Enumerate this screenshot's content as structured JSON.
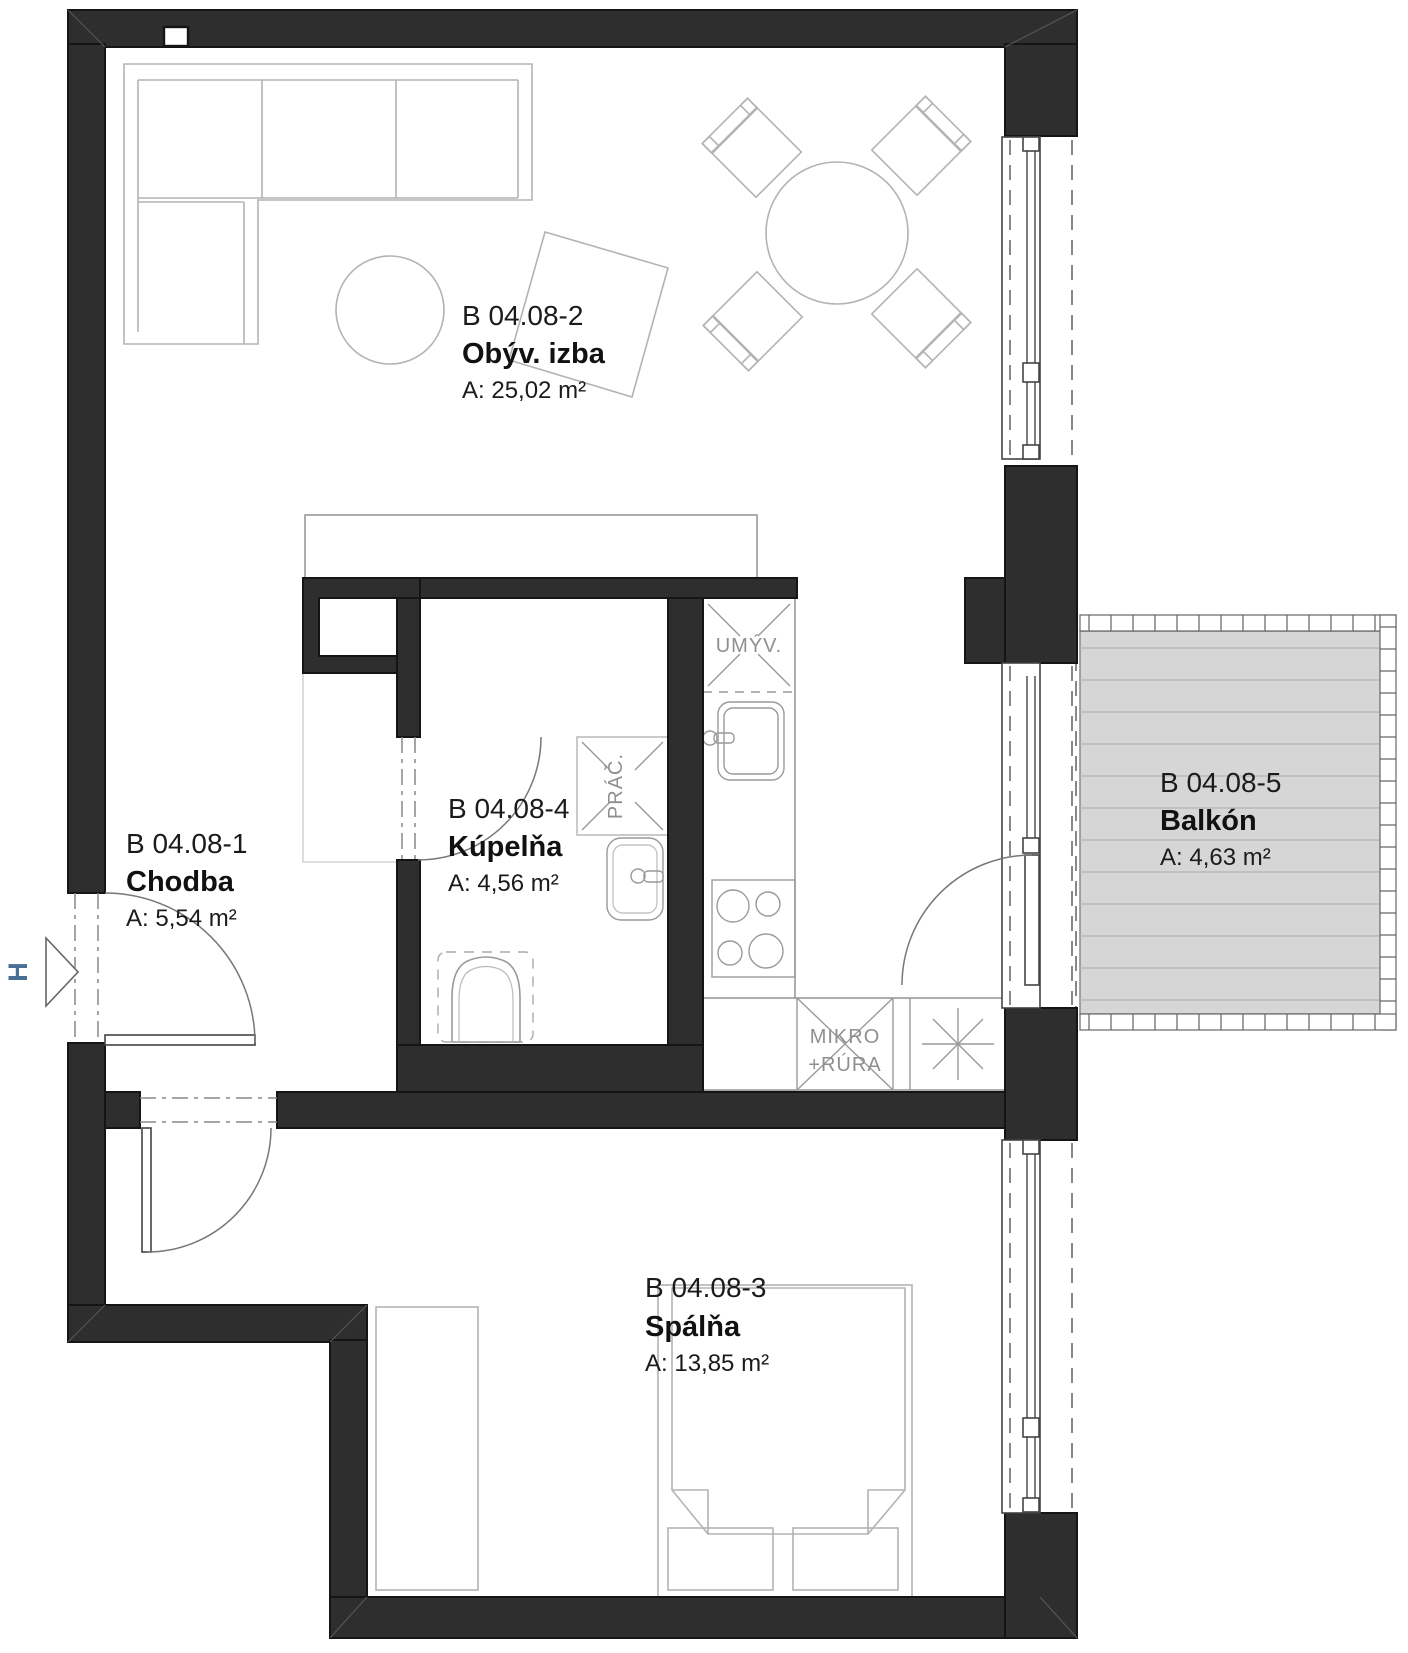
{
  "plan": {
    "rooms": {
      "hallway": {
        "id": "B 04.08-1",
        "name": "Chodba",
        "area": "A: 5,54 m²"
      },
      "living": {
        "id": "B 04.08-2",
        "name": "Obýv. izba",
        "area": "A: 25,02 m²"
      },
      "bedroom": {
        "id": "B 04.08-3",
        "name": "Spálňa",
        "area": "A: 13,85 m²"
      },
      "bathroom": {
        "id": "B 04.08-4",
        "name": "Kúpelňa",
        "area": "A: 4,56 m²"
      },
      "balcony": {
        "id": "B 04.08-5",
        "name": "Balkón",
        "area": "A: 4,63 m²"
      }
    },
    "fixtures": {
      "dishwasher": "UMÝV.",
      "washing_machine": "PRÁČ.",
      "microwave_line1": "MIKRO",
      "microwave_line2": "+RÚRA"
    },
    "entrance_marker": "H",
    "colors": {
      "wall": "#2e2e2e",
      "furniture_line": "#b3b3b3",
      "balcony_deck": "#d6d6d6",
      "entrance_accent": "#4a6f94"
    }
  }
}
